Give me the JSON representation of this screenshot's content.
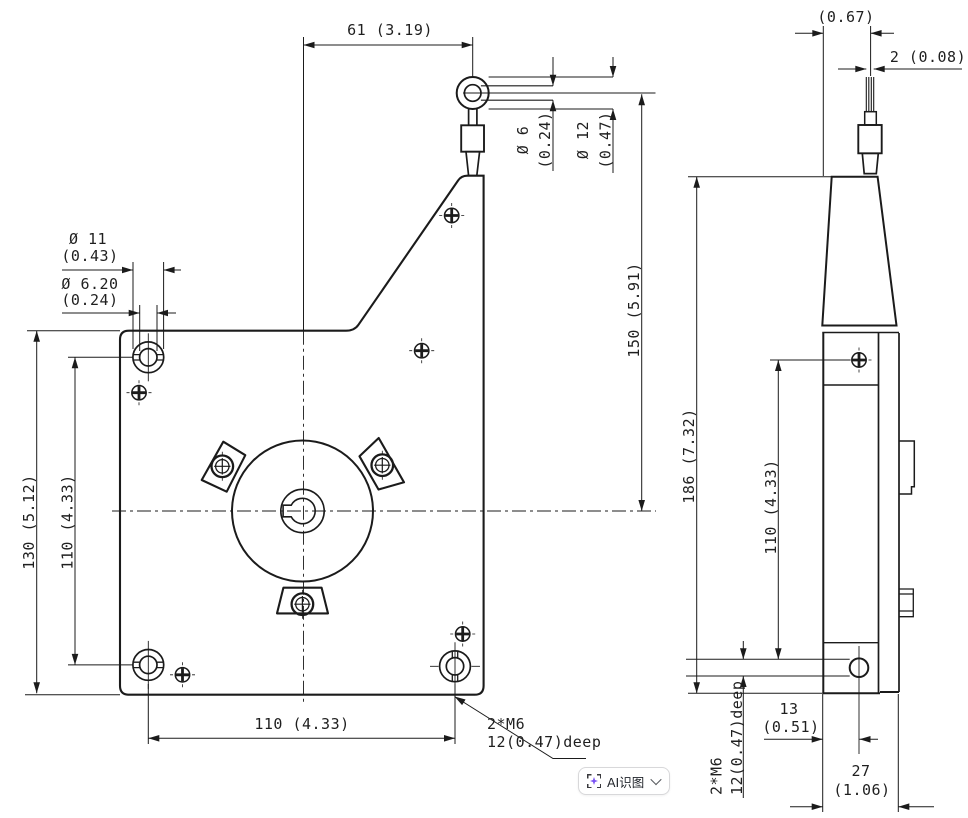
{
  "meta": {
    "description": "CAD engineering drawing, front and side orthographic views of a motor mount bracket with dimension callouts (mm and inch)",
    "ink_color": "#1b1b1b",
    "accent_purple": "#7a52f4",
    "button_border": "#d8d8da"
  },
  "front": {
    "dim_top_width": "61 (3.19)",
    "dim_pin_inner_l1": "Ø 6",
    "dim_pin_inner_l2": "(0.24)",
    "dim_pin_outer_l1": "Ø 12",
    "dim_pin_outer_l2": "(0.47)",
    "dim_pin_height": "150 (5.91)",
    "dim_cbore_l1": "Ø 11",
    "dim_cbore_l2": "(0.43)",
    "dim_hole_l1": "Ø 6.20",
    "dim_hole_l2": "(0.24)",
    "dim_body_height": "130 (5.12)",
    "dim_hole_spacing_v": "110 (4.33)",
    "dim_hole_spacing_h": "110 (4.33)",
    "thread_note_l1": "2*M6",
    "thread_note_l2": "12(0.47)deep"
  },
  "side": {
    "dim_top_offset": "(0.67)",
    "dim_wire_width": "2 (0.08)",
    "dim_total_height": "186 (7.32)",
    "dim_hole_spacing": "110 (4.33)",
    "thread_note_l1": "2*M6",
    "thread_note_l2": "12(0.47)deep",
    "dim_hole_offset_l1": "13",
    "dim_hole_offset_l2": "(0.51)",
    "dim_depth_l1": "27",
    "dim_depth_l2": "(1.06)"
  },
  "overlay": {
    "ai_button_label": "AI识图"
  }
}
